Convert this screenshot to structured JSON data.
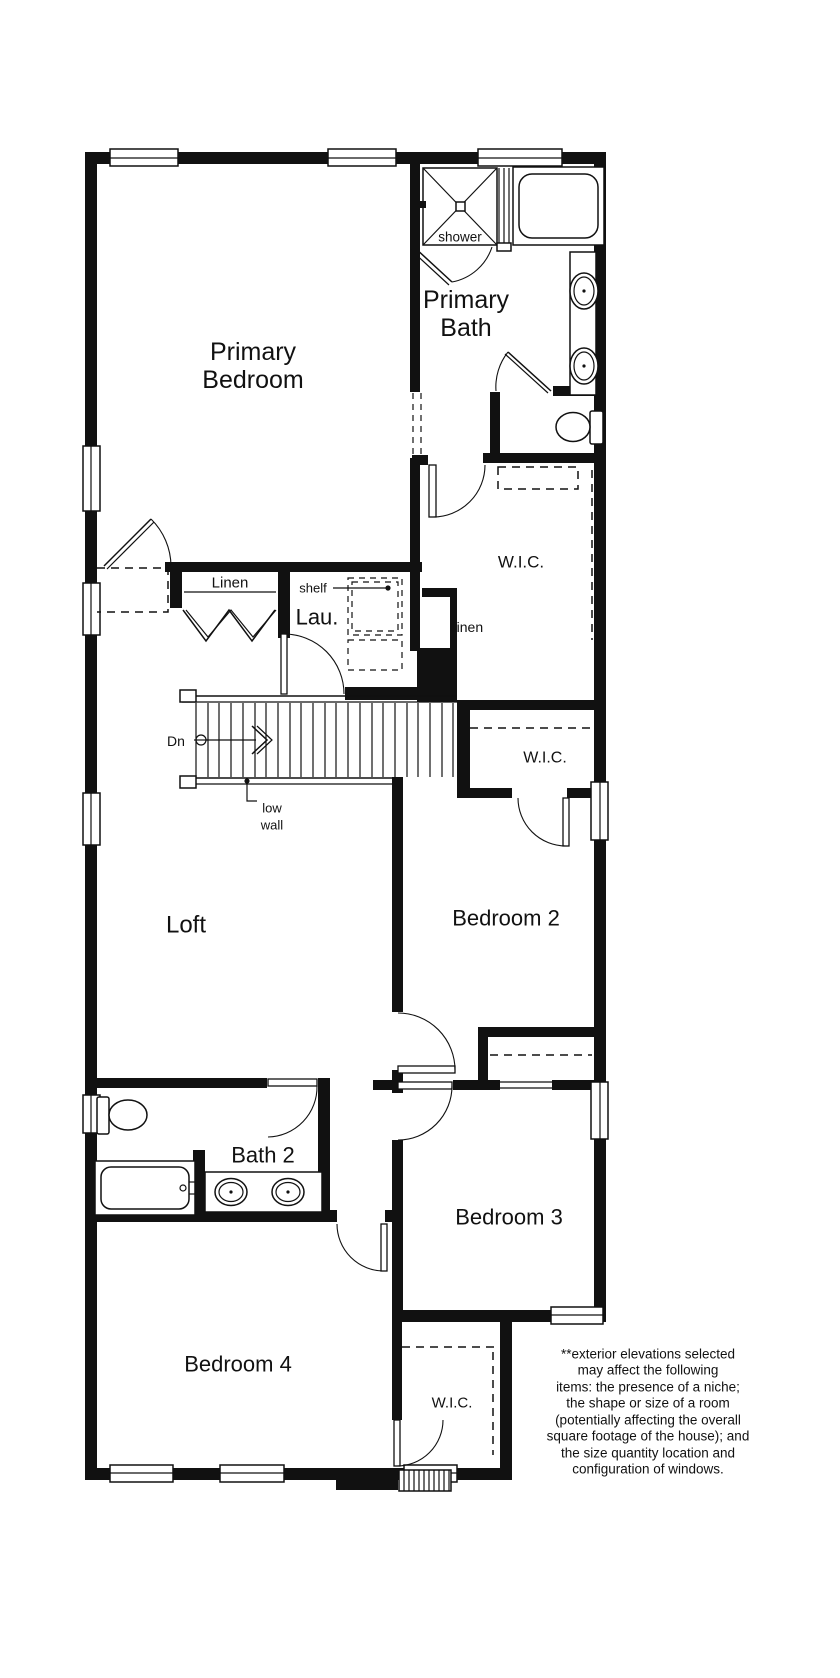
{
  "plan": {
    "colors": {
      "wall": "#111111",
      "background": "#ffffff"
    },
    "rooms": {
      "primary_bedroom": {
        "lines": [
          "Primary",
          "Bedroom"
        ]
      },
      "primary_bath": {
        "lines": [
          "Primary",
          "Bath"
        ]
      },
      "loft": {
        "label": "Loft"
      },
      "bedroom2": {
        "label": "Bedroom 2"
      },
      "bedroom3": {
        "label": "Bedroom 3"
      },
      "bedroom4": {
        "label": "Bedroom 4"
      },
      "bath2": {
        "label": "Bath 2"
      },
      "laundry": {
        "label": "Lau."
      },
      "wic_primary": {
        "label": "W.I.C."
      },
      "wic_bedroom2": {
        "label": "W.I.C."
      },
      "wic_bedroom4": {
        "label": "W.I.C."
      },
      "linen_hall": {
        "label": "Linen"
      },
      "linen_upper": {
        "label": "Linen"
      }
    },
    "annotations": {
      "shower": "shower",
      "shelf": "shelf",
      "stairs_down": "Dn",
      "low_wall": {
        "lines": [
          "low",
          "wall"
        ]
      }
    },
    "disclaimer": {
      "lines": [
        "**exterior elevations selected",
        "may affect the following",
        "items: the presence of a niche;",
        "the shape or size of a room",
        "(potentially affecting the overall",
        "square footage of the house); and",
        "the size quantity location and",
        "configuration of windows."
      ]
    }
  }
}
